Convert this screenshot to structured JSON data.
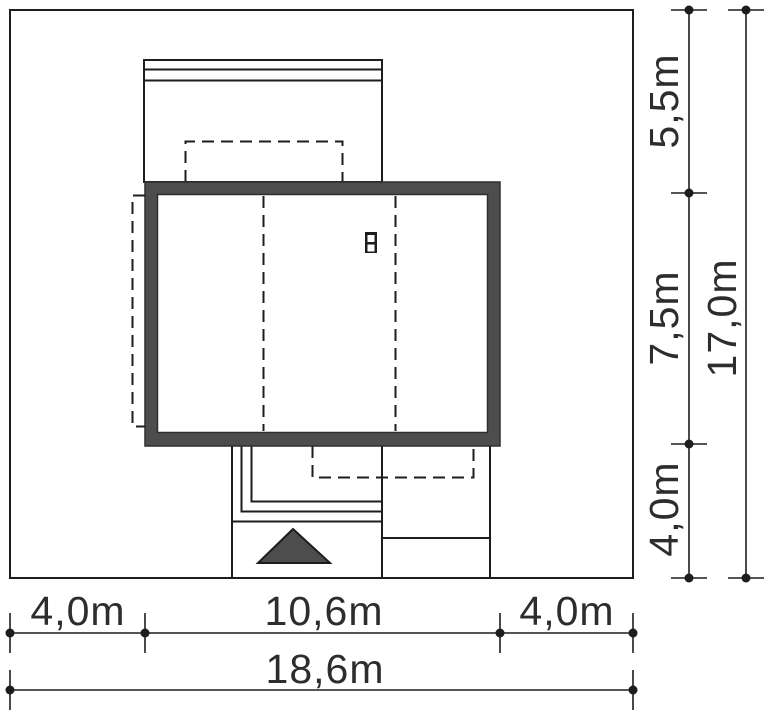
{
  "diagram": {
    "type": "architectural-site-plan",
    "bottom_dimensions": {
      "segments": [
        "4,0m",
        "10,6m",
        "4,0m"
      ],
      "total": "18,6m"
    },
    "right_dimensions": {
      "segments": [
        "5,5m",
        "7,5m",
        "4,0m"
      ],
      "total": "17,0m"
    },
    "icons": {
      "chimney": "chimney-icon",
      "entrance_arrow": "entrance-arrow-icon"
    },
    "colors": {
      "background": "#ffffff",
      "line": "#1d1d1b",
      "roof_fill": "#4d4d4d",
      "roof_outline": "#2e2e2e",
      "dimension_text": "#2d2d2b"
    }
  }
}
